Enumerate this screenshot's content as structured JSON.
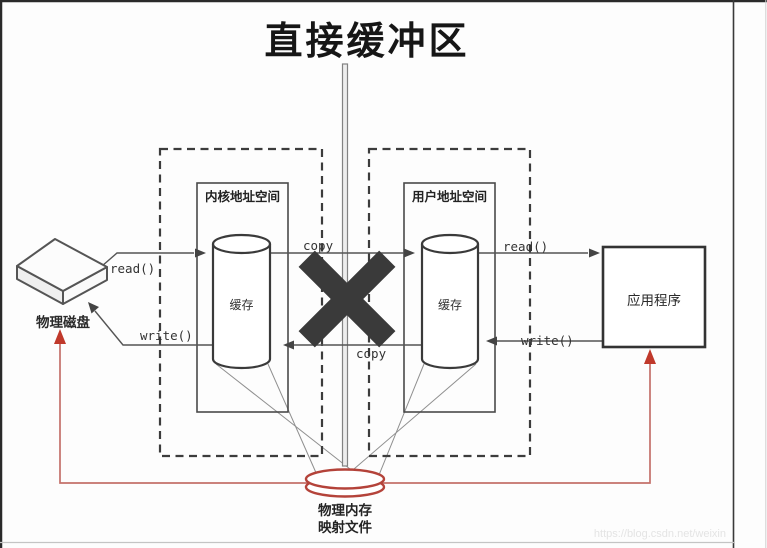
{
  "title": "直接缓冲区",
  "diagram": {
    "kernel_space_label": "内核地址空间",
    "user_space_label": "用户地址空间",
    "kernel_cache_label": "缓存",
    "user_cache_label": "缓存",
    "disk_label": "物理磁盘",
    "app_label": "应用程序",
    "read_left_label": "read()",
    "write_left_label": "write()",
    "copy_top_label": "copy",
    "copy_bottom_label": "copy",
    "read_right_label": "read()",
    "write_right_label": "write()",
    "mapped_file_line1": "物理内存",
    "mapped_file_line2": "映射文件"
  },
  "watermark": "https://blog.csdn.net/weixin",
  "colors": {
    "line": "#4a4a4a",
    "dashed_box": "#3c3c3c",
    "x_mark": "#3a3a3a",
    "red_line": "#c4706a",
    "red_accent": "#c0392b",
    "ellipse_stroke": "#b4433a"
  }
}
